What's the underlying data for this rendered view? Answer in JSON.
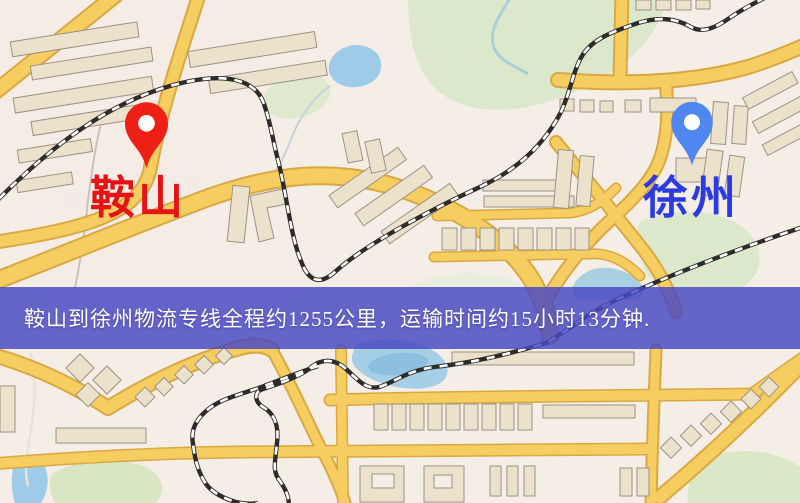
{
  "banner": {
    "text": "鞍山到徐州物流专线全程约1255公里，运输时间约15小时13分钟.",
    "background_rgba": "rgba(73,73,196,0.84)",
    "text_color": "#ffffff"
  },
  "route": {
    "origin": "鞍山",
    "destination": "徐州",
    "distance_text": "约1255公里",
    "duration_text": "约15小时13分钟"
  },
  "markers": {
    "origin": {
      "label": "鞍山",
      "pin_color": "#ee2015",
      "label_color": "#e51313"
    },
    "destination": {
      "label": "徐州",
      "pin_color": "#4f86ef",
      "label_color": "#2b3ae2"
    }
  },
  "map": {
    "colors": {
      "background": "#f4eee7",
      "road": "#f6cd60",
      "road_casing": "#d9a843",
      "water": "#9ecbe8",
      "park": "#dce8cb",
      "building": "#ece2cc",
      "railway": "#2e2c2a"
    }
  }
}
